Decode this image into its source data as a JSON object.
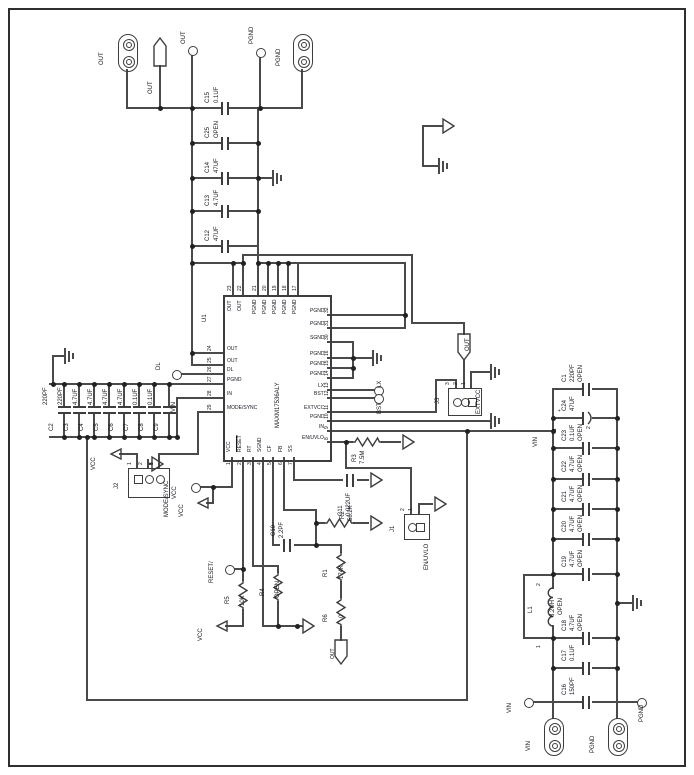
{
  "ic": {
    "refdes": "U1",
    "part": "MAXM17536ALY",
    "pins_top": [
      {
        "num": "23",
        "name": "OUT"
      },
      {
        "num": "22",
        "name": "OUT"
      },
      {
        "num": "21",
        "name": "PGND"
      },
      {
        "num": "20",
        "name": "PGND"
      },
      {
        "num": "19",
        "name": "PGND"
      },
      {
        "num": "18",
        "name": "PGND"
      },
      {
        "num": "17",
        "name": "PGND"
      }
    ],
    "pins_right": [
      {
        "num": "32",
        "name": "PGND"
      },
      {
        "num": "31",
        "name": "PGND"
      },
      {
        "num": "30",
        "name": "SGND"
      },
      {
        "num": "16",
        "name": "PGND"
      },
      {
        "num": "15",
        "name": "PGND"
      },
      {
        "num": "14",
        "name": "PGND"
      },
      {
        "num": "13",
        "name": "LX"
      },
      {
        "num": "12",
        "name": "BST"
      },
      {
        "num": "11",
        "name": "EXTVCC"
      },
      {
        "num": "10",
        "name": "PGND"
      },
      {
        "num": "9",
        "name": "IN"
      },
      {
        "num": "8",
        "name": "EN/UVLO"
      }
    ],
    "pins_left": [
      {
        "num": "24",
        "name": "OUT"
      },
      {
        "num": "25",
        "name": "OUT"
      },
      {
        "num": "26",
        "name": "DL"
      },
      {
        "num": "27",
        "name": "PGND"
      },
      {
        "num": "28",
        "name": "IN"
      },
      {
        "num": "29",
        "name": "MODE/SYNC"
      }
    ],
    "pins_bottom": [
      {
        "num": "1",
        "name": "VCC"
      },
      {
        "num": "2",
        "name": "RESET"
      },
      {
        "num": "3",
        "name": "RT"
      },
      {
        "num": "4",
        "name": "SGND"
      },
      {
        "num": "5",
        "name": "CF"
      },
      {
        "num": "6",
        "name": "FB"
      },
      {
        "num": "7",
        "name": "SS"
      }
    ]
  },
  "top_caps": [
    {
      "ref": "C15",
      "value": "0.1UF"
    },
    {
      "ref": "C25",
      "value": "OPEN"
    },
    {
      "ref": "C14",
      "value": "47UF"
    },
    {
      "ref": "C13",
      "value": "4.7UF"
    },
    {
      "ref": "C12",
      "value": "47UF"
    }
  ],
  "left_bank": [
    {
      "ref": "C2",
      "value": "220PF"
    },
    {
      "ref": "C3",
      "value": "220PF"
    },
    {
      "ref": "C4",
      "value": "4.7UF"
    },
    {
      "ref": "C5",
      "value": "4.7UF"
    },
    {
      "ref": "C6",
      "value": "4.7UF"
    },
    {
      "ref": "C7",
      "value": "4.7UF"
    },
    {
      "ref": "C8",
      "value": "0.1UF"
    },
    {
      "ref": "C9",
      "value": "0.1UF"
    }
  ],
  "right_bank": [
    {
      "ref": "C1",
      "value": "220PF",
      "extra": "OPEN"
    },
    {
      "ref": "C24",
      "value": "47UF",
      "extra": "",
      "plus": "+",
      "pin1": "1",
      "pin2": "2"
    },
    {
      "ref": "C23",
      "value": "0.1UF",
      "extra": "OPEN"
    },
    {
      "ref": "C22",
      "value": "4.7UF",
      "extra": "OPEN"
    },
    {
      "ref": "C21",
      "value": "4.7UF",
      "extra": "OPEN"
    },
    {
      "ref": "C20",
      "value": "4.7UF",
      "extra": "OPEN"
    },
    {
      "ref": "C19",
      "value": "4.7UF",
      "extra": "OPEN"
    },
    {
      "ref": "C18",
      "value": "4.7UF",
      "extra": "OPEN"
    },
    {
      "ref": "C17",
      "value": "0.1UF",
      "extra": ""
    },
    {
      "ref": "C16",
      "value": "150PF",
      "extra": ""
    }
  ],
  "inductor": {
    "ref": "L1",
    "value": "8.2UH",
    "extra": "OPEN",
    "pin_top": "2",
    "pin_bottom": "1"
  },
  "resistors": {
    "r1": {
      "ref": "R1",
      "value": "174K"
    },
    "r2": {
      "ref": "R2",
      "value": "56.2K"
    },
    "r3": {
      "ref": "R3",
      "value": "7.5M"
    },
    "r4": {
      "ref": "R4",
      "value": "OPEN"
    },
    "r5": {
      "ref": "R5",
      "value": "10K"
    },
    "r6": {
      "ref": "R6",
      "value": "0"
    }
  },
  "small_caps": {
    "c10": {
      "ref": "C10",
      "value": "2.2PF"
    },
    "c11": {
      "ref": "C11",
      "value": "0.022UF"
    }
  },
  "headers": {
    "j1": {
      "refdes": "J1",
      "label": "EN/UVLO",
      "pins": [
        "2",
        "1"
      ]
    },
    "j2": {
      "refdes": "J2",
      "label": "MODE/SYNC",
      "pins": [
        "1",
        "2",
        "3"
      ]
    },
    "j3": {
      "refdes": "J3",
      "label": "EXTVCC",
      "pins": [
        "3",
        "2",
        "1"
      ]
    }
  },
  "ports": {
    "out_conn": "OUT",
    "pgnd_conn_top": "PGND",
    "vin_conn": "VIN",
    "pgnd_conn_bottom": "PGND"
  },
  "testpoints": {
    "out_tp_top": "OUT",
    "out_circle": "OUT",
    "pgnd_circle": "PGND",
    "dl": "DL",
    "lx": "LX",
    "bst": "BST",
    "vcc_circle": "VCC",
    "reset": "RESET/",
    "vin_circle": "VIN",
    "pgnd_circle_bottom": "PGND",
    "out_flag_mid": "OUT",
    "out_flag_bottom": "OUT"
  },
  "net_labels": {
    "vcc1": "VCC",
    "vcc2": "VCC",
    "vcc3": "VCC",
    "vin_ic": "VIN",
    "vin_rail": "VIN"
  }
}
